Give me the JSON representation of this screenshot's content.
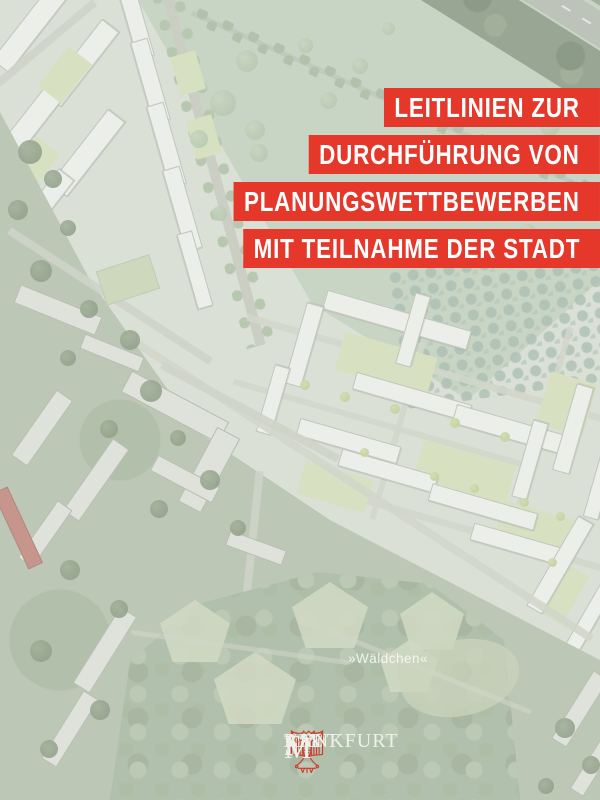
{
  "cover": {
    "title_lines": [
      "LEITLINIEN ZUR",
      "DURCHFÜHRUNG VON",
      "PLANUNGSWETTBEWERBEN",
      "MIT TEILNAHME DER STADT"
    ],
    "banner_color": "#e5382b",
    "title_text_color": "#ffffff"
  },
  "map": {
    "forest_label": "»Wäldchen«"
  },
  "logo": {
    "stadt_initial": "S",
    "stadt_rest": "TADT",
    "frankfurt_initial": "F",
    "frankfurt_rest": "RANKFURT",
    "am": "AM",
    "main_initial": "M",
    "main_rest": "AIN",
    "crest_color": "#cf3a2a",
    "text_color": "#eef1ea"
  }
}
